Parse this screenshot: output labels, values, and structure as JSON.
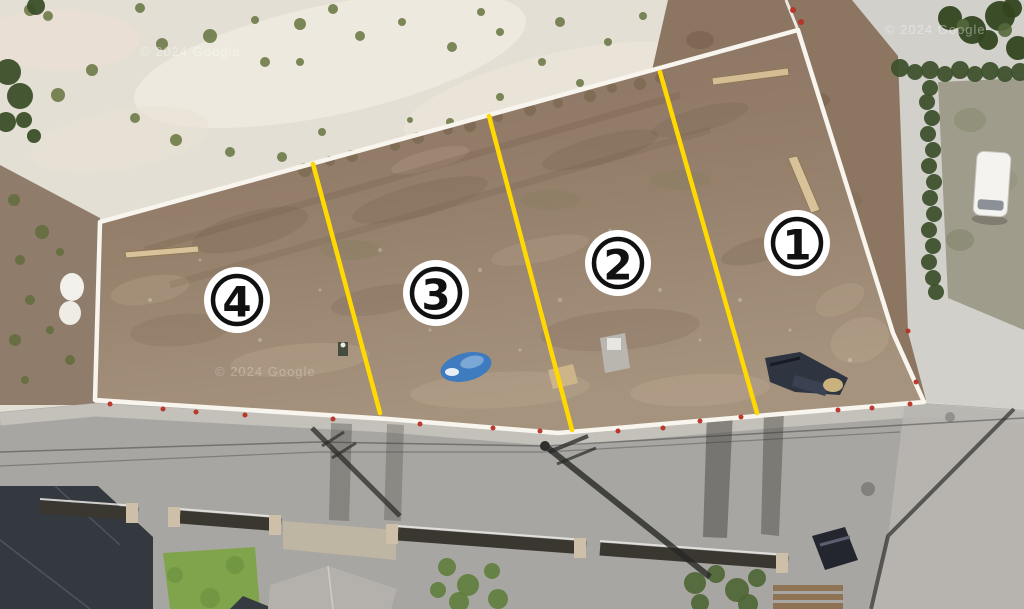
{
  "watermark": {
    "text": "© 2024 Google"
  },
  "plots": [
    {
      "id": "plot-1",
      "label": "1"
    },
    {
      "id": "plot-2",
      "label": "2"
    },
    {
      "id": "plot-3",
      "label": "3"
    },
    {
      "id": "plot-4",
      "label": "4"
    }
  ],
  "colors": {
    "divider_line": "#ffd900",
    "boundary_line": "#f8f5ef",
    "marker_background": "#ffffff",
    "marker_foreground": "#111111"
  }
}
